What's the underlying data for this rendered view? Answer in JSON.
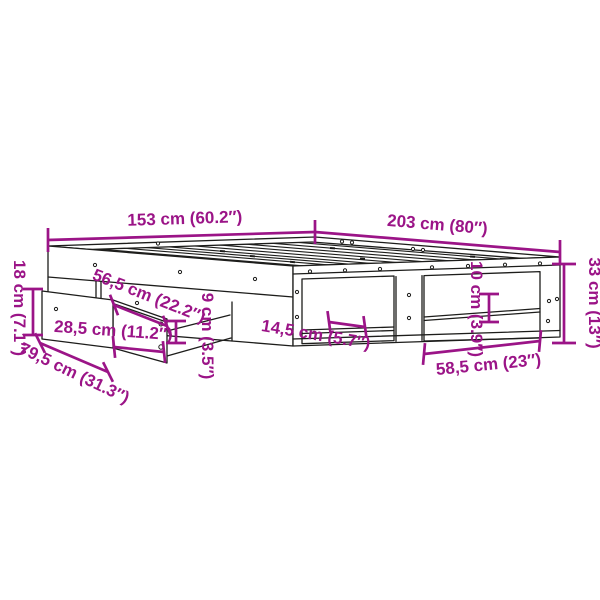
{
  "diagram": {
    "type": "product-dimension-diagram",
    "subject": "bed-frame-with-drawer-and-shelves",
    "colors": {
      "background": "#ffffff",
      "line_art": "#1d1d1b",
      "dimension_annotation": "#9b1487"
    },
    "dimensions": [
      {
        "id": "width",
        "label": "153 cm (60.2″)",
        "cm": "153",
        "inches": "60.2"
      },
      {
        "id": "length",
        "label": "203 cm (80″)",
        "cm": "203",
        "inches": "80"
      },
      {
        "id": "frame-height",
        "label": "33 cm (13″)",
        "cm": "33",
        "inches": "13"
      },
      {
        "id": "drawer-height",
        "label": "18 cm (7.1″)",
        "cm": "18",
        "inches": "7.1"
      },
      {
        "id": "drawer-depth",
        "label": "56,5 cm (22.2″)",
        "cm": "56,5",
        "inches": "22.2"
      },
      {
        "id": "drawer-width",
        "label": "28,5 cm (11.2″)",
        "cm": "28,5",
        "inches": "11.2"
      },
      {
        "id": "drawer-length",
        "label": "79,5 cm (31.3″)",
        "cm": "79,5",
        "inches": "31.3"
      },
      {
        "id": "rail-gap",
        "label": "9 cm (3.5″)",
        "cm": "9",
        "inches": "3.5"
      },
      {
        "id": "shelf-gap-left",
        "label": "14,5 cm (5.7″)",
        "cm": "14,5",
        "inches": "5.7"
      },
      {
        "id": "shelf-gap-right",
        "label": "10 cm (3.9″)",
        "cm": "10",
        "inches": "3.9"
      },
      {
        "id": "shelf-width",
        "label": "58,5 cm (23″)",
        "cm": "58,5",
        "inches": "23"
      }
    ]
  }
}
